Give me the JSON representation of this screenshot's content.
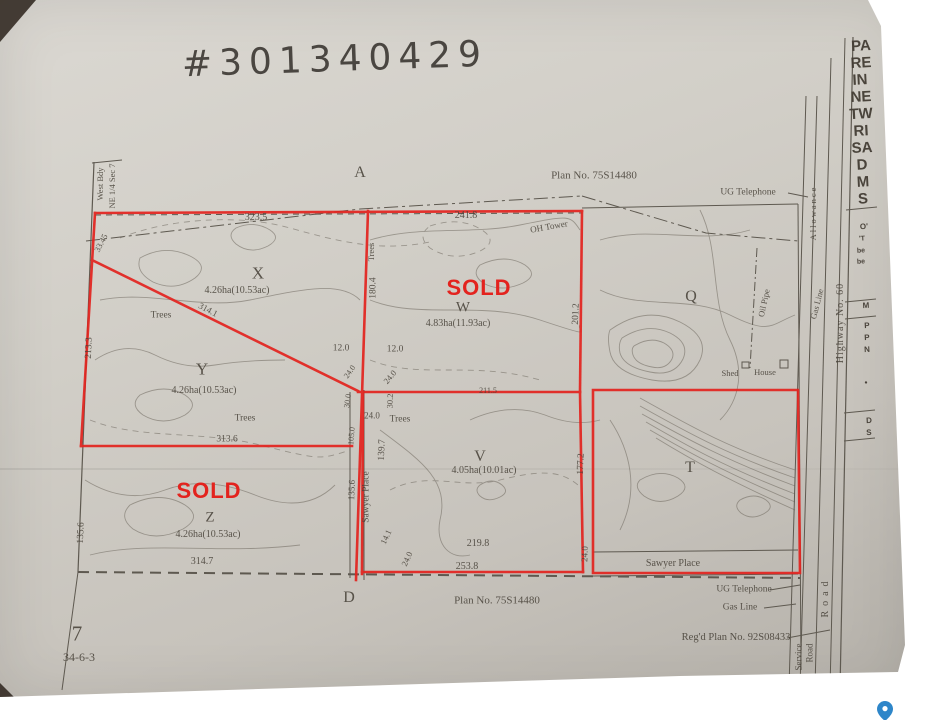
{
  "colors": {
    "annotation_red": "#e3231e",
    "paper": "#cdc9c2",
    "ink": "#55504a",
    "pin_blue": "#2e86c9"
  },
  "summary": {
    "handwritten_number": "#301340429",
    "plan_number_top": "Plan No. 75S14480",
    "plan_number_bottom": "Plan No. 75S14480",
    "registered_plan": "Reg'd Plan No. 92S08433",
    "section_number": "7",
    "township_range": "34-6-3",
    "corner_labels": [
      "A",
      "D"
    ],
    "parcels": [
      {
        "id": "X",
        "area": "4.26ha(10.53ac)",
        "status": ""
      },
      {
        "id": "Y",
        "area": "4.26ha(10.53ac)",
        "status": ""
      },
      {
        "id": "Z",
        "area": "4.26ha(10.53ac)",
        "status": "SOLD"
      },
      {
        "id": "W",
        "area": "4.83ha(11.93ac)",
        "status": "SOLD"
      },
      {
        "id": "V",
        "area": "4.05ha(10.01ac)",
        "status": ""
      },
      {
        "id": "Q",
        "area": "",
        "status": ""
      },
      {
        "id": "T",
        "area": "",
        "status": ""
      }
    ],
    "roads": [
      "Highway No. 60",
      "Service Road",
      "Sawyer Place",
      "Allowance",
      "Road"
    ],
    "utilities": [
      "UG Telephone",
      "Gas Line",
      "Oil Pipe",
      "OH Tower"
    ],
    "structures": [
      "Shed",
      "House"
    ],
    "boundary_note": [
      "West Bdy",
      "NE 1/4 Sec 7"
    ]
  },
  "labels": [
    {
      "n": "handwritten-file-number",
      "t": "#301340429",
      "x": 335,
      "y": 60,
      "s": 36,
      "r": -2,
      "c": "hand",
      "ls": 7
    },
    {
      "n": "corner-label-a",
      "t": "A",
      "x": 360,
      "y": 173,
      "s": 16
    },
    {
      "n": "plan-number-top",
      "t": "Plan No. 75S14480",
      "x": 594,
      "y": 176,
      "s": 11
    },
    {
      "n": "ug-telephone-top",
      "t": "UG Telephone",
      "x": 748,
      "y": 193,
      "s": 9.5
    },
    {
      "n": "west-bdy-label",
      "t": "West Bdy",
      "x": 100,
      "y": 184,
      "s": 8.5,
      "r": -90
    },
    {
      "n": "west-bdy-sec-label",
      "t": "NE 1/4 Sec 7",
      "x": 112,
      "y": 186,
      "s": 8.5,
      "r": -90
    },
    {
      "n": "dim-323-5",
      "t": "323.5",
      "x": 256,
      "y": 218,
      "s": 10
    },
    {
      "n": "dim-241-8",
      "t": "241.8",
      "x": 466,
      "y": 216,
      "s": 10
    },
    {
      "n": "dim-33-45",
      "t": "33.45",
      "x": 101,
      "y": 243,
      "s": 8.5,
      "r": -62
    },
    {
      "n": "parcel-x-label",
      "t": "X",
      "x": 258,
      "y": 273,
      "s": 17
    },
    {
      "n": "parcel-x-area",
      "t": "4.26ha(10.53ac)",
      "x": 237,
      "y": 291,
      "s": 10
    },
    {
      "n": "trees-label-x",
      "t": "Trees",
      "x": 161,
      "y": 316,
      "s": 9.5
    },
    {
      "n": "dim-314-1",
      "t": "314.1",
      "x": 208,
      "y": 310,
      "s": 9,
      "r": 28
    },
    {
      "n": "dim-213-3",
      "t": "213.3",
      "x": 90,
      "y": 348,
      "s": 9.5,
      "r": -88
    },
    {
      "n": "parcel-y-label",
      "t": "Y",
      "x": 202,
      "y": 369,
      "s": 17
    },
    {
      "n": "parcel-y-area",
      "t": "4.26ha(10.53ac)",
      "x": 204,
      "y": 391,
      "s": 10
    },
    {
      "n": "trees-label-y",
      "t": "Trees",
      "x": 245,
      "y": 419,
      "s": 9.5
    },
    {
      "n": "trees-label-vertical",
      "t": "Trees",
      "x": 371,
      "y": 252,
      "s": 8.5,
      "r": -90
    },
    {
      "n": "dim-180-4",
      "t": "180.4",
      "x": 374,
      "y": 288,
      "s": 9.5,
      "r": -90
    },
    {
      "n": "dim-12-0-a",
      "t": "12.0",
      "x": 341,
      "y": 349,
      "s": 9.5
    },
    {
      "n": "dim-12-0-b",
      "t": "12.0",
      "x": 395,
      "y": 350,
      "s": 9.5
    },
    {
      "n": "dim-24-0-a",
      "t": "24.0",
      "x": 350,
      "y": 372,
      "s": 8,
      "r": -55
    },
    {
      "n": "dim-24-0-b",
      "t": "24.0",
      "x": 390,
      "y": 377,
      "s": 8.5,
      "r": -50
    },
    {
      "n": "dim-30-0",
      "t": "30.0",
      "x": 348,
      "y": 401,
      "s": 8,
      "r": -82
    },
    {
      "n": "dim-30-2",
      "t": "30.2",
      "x": 390,
      "y": 401,
      "s": 8.5,
      "r": -88
    },
    {
      "n": "dim-24-0-c",
      "t": "24.0",
      "x": 372,
      "y": 416,
      "s": 9
    },
    {
      "n": "dim-105-0",
      "t": "105.0",
      "x": 352,
      "y": 436,
      "s": 8,
      "r": -85
    },
    {
      "n": "dim-139-7",
      "t": "139.7",
      "x": 383,
      "y": 450,
      "s": 9.5,
      "r": -88
    },
    {
      "n": "road-sawyer-place-vertical",
      "t": "Sawyer Place",
      "x": 367,
      "y": 497,
      "s": 9.5,
      "r": -90
    },
    {
      "n": "dim-135-6-a",
      "t": "135.6",
      "x": 352,
      "y": 490,
      "s": 9,
      "r": -88
    },
    {
      "n": "sold-stamp-w",
      "t": "SOLD",
      "x": 479,
      "y": 288,
      "s": 22,
      "c": "red"
    },
    {
      "n": "parcel-w-label",
      "t": "W",
      "x": 463,
      "y": 308,
      "s": 15
    },
    {
      "n": "parcel-w-area",
      "t": "4.83ha(11.93ac)",
      "x": 458,
      "y": 324,
      "s": 10
    },
    {
      "n": "oh-tower-label",
      "t": "OH Tower",
      "x": 549,
      "y": 227,
      "s": 9,
      "r": -10
    },
    {
      "n": "dim-201-2",
      "t": "201.2",
      "x": 577,
      "y": 314,
      "s": 9.5,
      "r": -88
    },
    {
      "n": "dim-211-5",
      "t": "211.5",
      "x": 488,
      "y": 391,
      "s": 8
    },
    {
      "n": "parcel-q-label",
      "t": "Q",
      "x": 691,
      "y": 297,
      "s": 16
    },
    {
      "n": "oil-pipe-label",
      "t": "Oil Pipe",
      "x": 764,
      "y": 303,
      "s": 8.5,
      "r": -78
    },
    {
      "n": "shed-label",
      "t": "Shed",
      "x": 730,
      "y": 373,
      "s": 8.5
    },
    {
      "n": "house-label",
      "t": "House",
      "x": 765,
      "y": 372,
      "s": 8.5
    },
    {
      "n": "parcel-v-label",
      "t": "V",
      "x": 480,
      "y": 457,
      "s": 16
    },
    {
      "n": "parcel-v-area",
      "t": "4.05ha(10.01ac)",
      "x": 484,
      "y": 471,
      "s": 10
    },
    {
      "n": "trees-label-v",
      "t": "Trees",
      "x": 400,
      "y": 420,
      "s": 9.5
    },
    {
      "n": "dim-177-2",
      "t": "177.2",
      "x": 582,
      "y": 464,
      "s": 9.5,
      "r": -88
    },
    {
      "n": "dim-14-1",
      "t": "14.1",
      "x": 386,
      "y": 537,
      "s": 8.5,
      "r": -65
    },
    {
      "n": "dim-24-0-d",
      "t": "24.0",
      "x": 407,
      "y": 559,
      "s": 8.5,
      "r": -65
    },
    {
      "n": "dim-219-8",
      "t": "219.8",
      "x": 478,
      "y": 544,
      "s": 10
    },
    {
      "n": "dim-253-8",
      "t": "253.8",
      "x": 467,
      "y": 567,
      "s": 10
    },
    {
      "n": "dim-24-0-e",
      "t": "24.0",
      "x": 585,
      "y": 554,
      "s": 9,
      "r": -88
    },
    {
      "n": "parcel-t-label",
      "t": "T",
      "x": 690,
      "y": 468,
      "s": 16
    },
    {
      "n": "road-sawyer-place-horizontal",
      "t": "Sawyer  Place",
      "x": 673,
      "y": 564,
      "s": 10
    },
    {
      "n": "ug-telephone-bottom",
      "t": "UG Telephone",
      "x": 744,
      "y": 590,
      "s": 9.5
    },
    {
      "n": "gas-line-bottom",
      "t": "Gas Line",
      "x": 740,
      "y": 608,
      "s": 9.5
    },
    {
      "n": "regd-plan-number",
      "t": "Reg'd Plan No. 92S08433",
      "x": 736,
      "y": 638,
      "s": 10.5
    },
    {
      "n": "service-road-label-1",
      "t": "Service",
      "x": 799,
      "y": 657,
      "s": 9,
      "r": -90
    },
    {
      "n": "service-road-label-2",
      "t": "Road",
      "x": 810,
      "y": 653,
      "s": 9,
      "r": -90
    },
    {
      "n": "road-vertical-label",
      "t": "Road",
      "x": 826,
      "y": 597,
      "s": 10,
      "r": -90,
      "ls": 5
    },
    {
      "n": "allowance-label",
      "t": "Allowance",
      "x": 813,
      "y": 213,
      "s": 8.5,
      "r": -90,
      "ls": 2
    },
    {
      "n": "gas-line-vertical",
      "t": "Gas Line",
      "x": 817,
      "y": 304,
      "s": 8.5,
      "r": -76
    },
    {
      "n": "highway-60-label",
      "t": "Highway No. 60",
      "x": 841,
      "y": 323,
      "s": 10,
      "r": -90,
      "ls": 1
    },
    {
      "n": "sold-stamp-z",
      "t": "SOLD",
      "x": 209,
      "y": 491,
      "s": 22,
      "c": "red"
    },
    {
      "n": "parcel-z-label",
      "t": "Z",
      "x": 210,
      "y": 518,
      "s": 15
    },
    {
      "n": "parcel-z-area",
      "t": "4.26ha(10.53ac)",
      "x": 208,
      "y": 535,
      "s": 10
    },
    {
      "n": "dim-135-6-b",
      "t": "135.6",
      "x": 82,
      "y": 533,
      "s": 9.5,
      "r": -88
    },
    {
      "n": "dim-314-7",
      "t": "314.7",
      "x": 202,
      "y": 562,
      "s": 10
    },
    {
      "n": "dim-313-6",
      "t": "313.6",
      "x": 227,
      "y": 440,
      "s": 9.5
    },
    {
      "n": "corner-label-d",
      "t": "D",
      "x": 349,
      "y": 598,
      "s": 16
    },
    {
      "n": "plan-number-bottom",
      "t": "Plan No. 75S14480",
      "x": 497,
      "y": 601,
      "s": 11
    },
    {
      "n": "section-number",
      "t": "7",
      "x": 77,
      "y": 634,
      "s": 21
    },
    {
      "n": "township-label",
      "t": "34-6-3",
      "x": 79,
      "y": 657,
      "s": 12
    },
    {
      "n": "titleblock-line-1",
      "t": "PA",
      "x": 861,
      "y": 46,
      "s": 15,
      "r": -3,
      "c": "tb"
    },
    {
      "n": "titleblock-line-2",
      "t": "RE",
      "x": 861,
      "y": 63,
      "s": 15,
      "r": -3,
      "c": "tb"
    },
    {
      "n": "titleblock-line-3",
      "t": "IN",
      "x": 860,
      "y": 80,
      "s": 15,
      "r": -3,
      "c": "tb"
    },
    {
      "n": "titleblock-line-4",
      "t": "NE",
      "x": 861,
      "y": 97,
      "s": 15,
      "r": -3,
      "c": "tb"
    },
    {
      "n": "titleblock-line-5",
      "t": "TW",
      "x": 861,
      "y": 114,
      "s": 15,
      "r": -3,
      "c": "tb"
    },
    {
      "n": "titleblock-line-6",
      "t": "RI",
      "x": 861,
      "y": 131,
      "s": 15,
      "r": -3,
      "c": "tb"
    },
    {
      "n": "titleblock-line-7",
      "t": "SA",
      "x": 862,
      "y": 148,
      "s": 15,
      "r": -3,
      "c": "tb"
    },
    {
      "n": "titleblock-line-8",
      "t": "D",
      "x": 862,
      "y": 165,
      "s": 15,
      "r": -3,
      "c": "tb"
    },
    {
      "n": "titleblock-line-9",
      "t": "M",
      "x": 863,
      "y": 182,
      "s": 15,
      "r": -3,
      "c": "tb"
    },
    {
      "n": "titleblock-line-10",
      "t": "S",
      "x": 863,
      "y": 199,
      "s": 15,
      "r": -3,
      "c": "tb"
    },
    {
      "n": "titleblock-frag-1",
      "t": "O'",
      "x": 864,
      "y": 227,
      "s": 8,
      "r": -3,
      "c": "tb"
    },
    {
      "n": "titleblock-frag-2",
      "t": "'T",
      "x": 862,
      "y": 239,
      "s": 7,
      "r": -3,
      "c": "tb"
    },
    {
      "n": "titleblock-frag-3",
      "t": "be",
      "x": 861,
      "y": 251,
      "s": 7,
      "r": -3,
      "c": "tb"
    },
    {
      "n": "titleblock-frag-4",
      "t": "be",
      "x": 861,
      "y": 262,
      "s": 7,
      "r": -3,
      "c": "tb"
    },
    {
      "n": "titleblock-frag-5",
      "t": "M",
      "x": 866,
      "y": 306,
      "s": 8,
      "r": -3,
      "c": "tb"
    },
    {
      "n": "titleblock-frag-6",
      "t": "P",
      "x": 867,
      "y": 326,
      "s": 8,
      "r": -3,
      "c": "tb"
    },
    {
      "n": "titleblock-frag-7",
      "t": "P",
      "x": 867,
      "y": 338,
      "s": 8,
      "r": -3,
      "c": "tb"
    },
    {
      "n": "titleblock-frag-8",
      "t": "N",
      "x": 867,
      "y": 350,
      "s": 8,
      "r": -3,
      "c": "tb"
    },
    {
      "n": "titleblock-frag-9",
      "t": "•",
      "x": 866,
      "y": 383,
      "s": 8,
      "r": -3,
      "c": "tb"
    },
    {
      "n": "titleblock-frag-10",
      "t": "D",
      "x": 869,
      "y": 421,
      "s": 8,
      "r": -3,
      "c": "tb"
    },
    {
      "n": "titleblock-frag-11",
      "t": "S",
      "x": 869,
      "y": 433,
      "s": 8,
      "r": -3,
      "c": "tb"
    }
  ]
}
